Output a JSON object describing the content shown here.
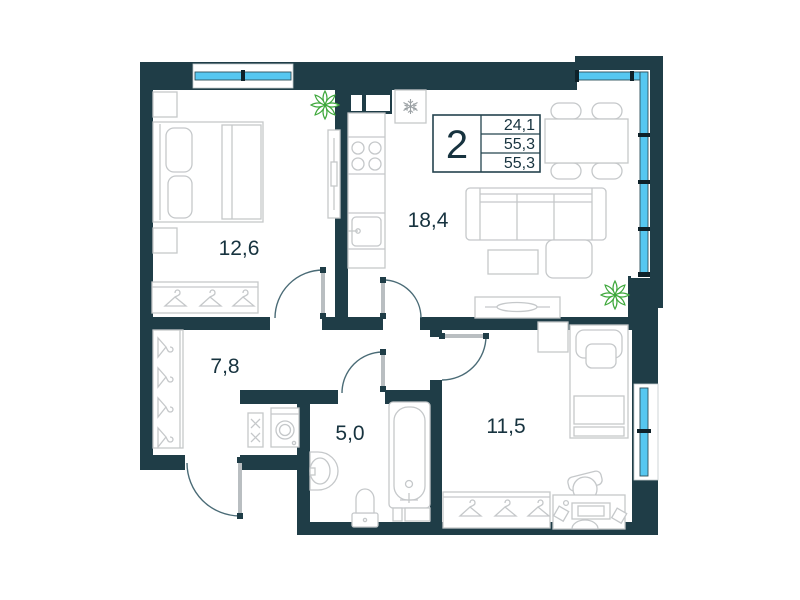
{
  "plan": {
    "legend": {
      "rooms_count": "2",
      "stats": [
        "24,1",
        "55,3",
        "55,3"
      ]
    },
    "rooms": [
      {
        "id": "bedroom",
        "area": "12,6"
      },
      {
        "id": "kitchen-living",
        "area": "18,4"
      },
      {
        "id": "hallway",
        "area": "7,8"
      },
      {
        "id": "bathroom",
        "area": "5,0"
      },
      {
        "id": "kids-room",
        "area": "11,5"
      }
    ]
  },
  "colors": {
    "wall": "#1f3d47",
    "window": "#56c7f0",
    "furniture": "#c5c8ca",
    "door": "#4a6b76",
    "text": "#17333f",
    "legendBorder": "#24434e",
    "plant": "#3fa83c"
  }
}
